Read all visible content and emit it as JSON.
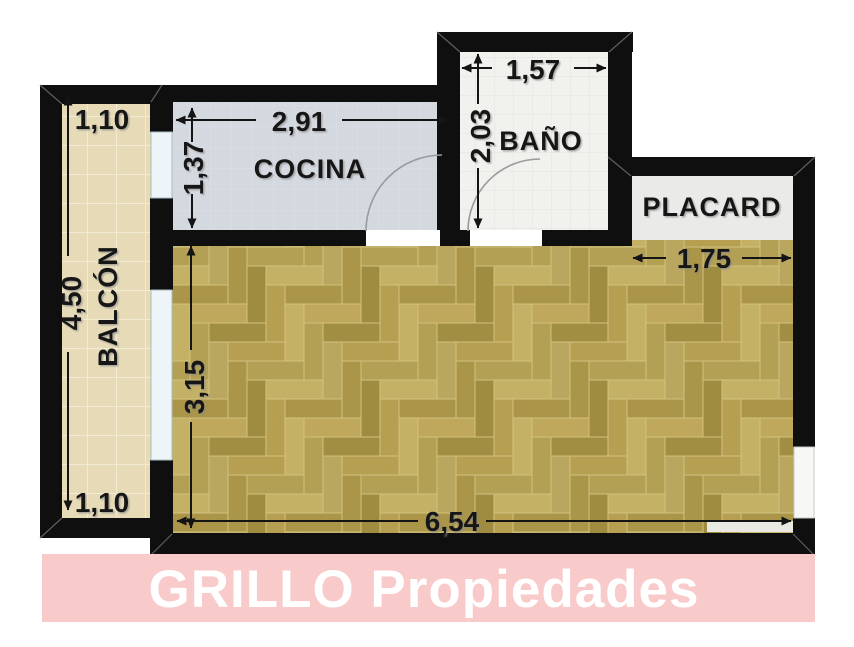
{
  "plan": {
    "labels": {
      "balcon": "BALCÓN",
      "cocina": "COCINA",
      "bano": "BAÑO",
      "placard": "PLACARD"
    },
    "dims": {
      "balcon_top": "1,10",
      "balcon_side": "4,50",
      "balcon_bottom": "1,10",
      "cocina_width": "2,91",
      "cocina_depth": "1,37",
      "bano_width": "1,57",
      "bano_depth": "2,03",
      "placard_width": "1,75",
      "living_depth": "3,15",
      "living_width": "6,54"
    },
    "colors": {
      "wall": "#0f0f0f",
      "balcon_floor": "#e7dbb7",
      "cocina_floor": "#d4d8df",
      "bano_floor": "#f1f1ee",
      "placard_floor": "#eaeae8",
      "wood_grout": "#d2c27e",
      "window": "#edf5f8",
      "door_arc": "#9a9a9a",
      "dim_text": "#141414"
    }
  },
  "banner": {
    "text": "GRILLO Propiedades",
    "bg": "#f9caca",
    "fg": "#ffffff"
  }
}
